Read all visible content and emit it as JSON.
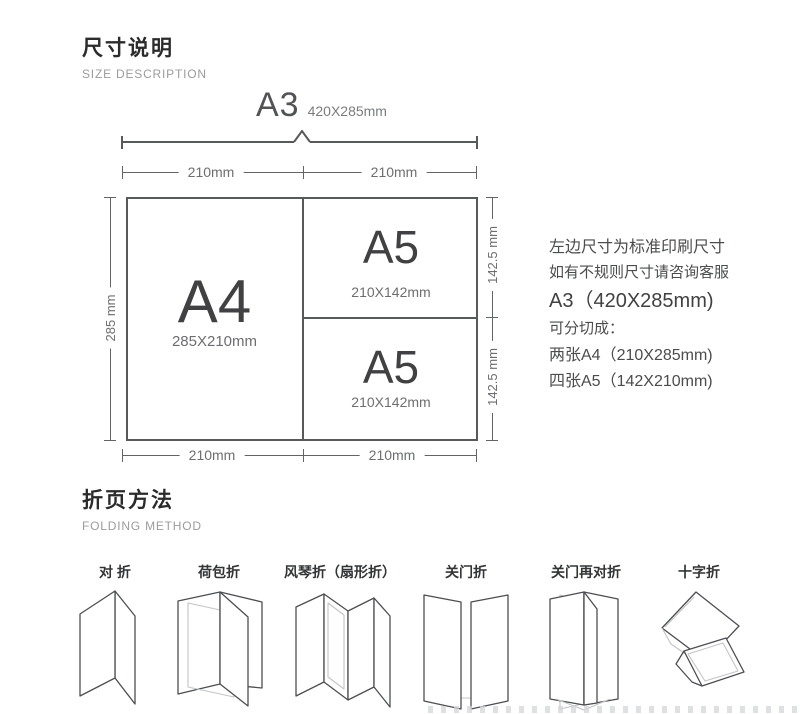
{
  "size_section": {
    "title": "尺寸说明",
    "subtitle": "SIZE DESCRIPTION",
    "a3_label": "A3",
    "a3_dims": "420X285mm",
    "top_width_left": "210mm",
    "top_width_right": "210mm",
    "bottom_width_left": "210mm",
    "bottom_width_right": "210mm",
    "left_height": "285 mm",
    "right_height_top": "142.5 mm",
    "right_height_bottom": "142.5 mm",
    "a4": {
      "label": "A4",
      "dims": "285X210mm"
    },
    "a5_top": {
      "label": "A5",
      "dims": "210X142mm"
    },
    "a5_bottom": {
      "label": "A5",
      "dims": "210X142mm"
    },
    "notes": {
      "line1": "左边尺寸为标准印刷尺寸",
      "line2": "如有不规则尺寸请咨询客服",
      "line3": "A3（420X285mm)",
      "line4": "可分切成：",
      "line5": "两张A4（210X285mm)",
      "line6": "四张A5（142X210mm)"
    }
  },
  "folding_section": {
    "title": "折页方法",
    "subtitle": "FOLDING METHOD",
    "methods": [
      {
        "label": "对 折",
        "icon": "half-fold-icon"
      },
      {
        "label": "荷包折",
        "icon": "wrap-fold-icon"
      },
      {
        "label": "风琴折（扇形折）",
        "icon": "accordion-fold-icon"
      },
      {
        "label": "关门折",
        "icon": "gate-fold-icon"
      },
      {
        "label": "关门再对折",
        "icon": "gate-then-half-fold-icon"
      },
      {
        "label": "十字折",
        "icon": "cross-fold-icon"
      }
    ]
  },
  "colors": {
    "line": "#58595b",
    "dim_text": "#6d6e71",
    "heading": "#2b2b2b",
    "subtitle": "#9b9c9e",
    "big_letter": "#414042",
    "light_fold_line": "#c3c4c7"
  }
}
